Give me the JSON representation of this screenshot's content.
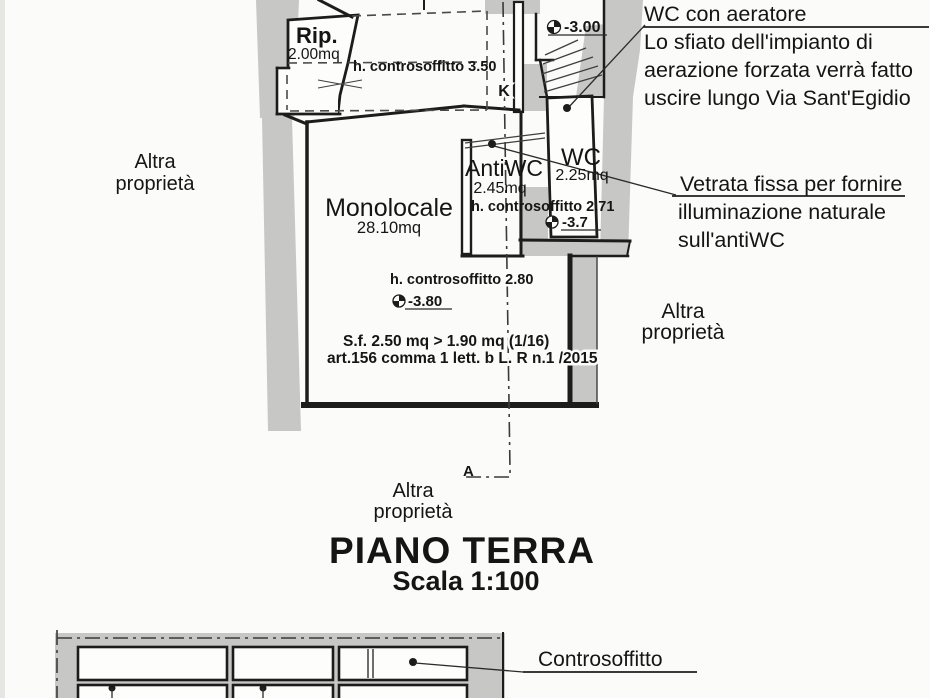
{
  "title": {
    "main": "PIANO TERRA",
    "scale": "Scala 1:100"
  },
  "rooms": {
    "rip": {
      "name": "Rip.",
      "area": "2.00mq"
    },
    "monolocale": {
      "name": "Monolocale",
      "area": "28.10mq"
    },
    "antiwc": {
      "name": "AntiWC",
      "area": "2.45mq"
    },
    "wc": {
      "name": "WC",
      "area": "2.25mq"
    }
  },
  "ceiling_heights": {
    "hall": "h. controsoffitto 3.50",
    "antiwc": "h. controsoffitto 2.71",
    "monolocale": "h. controsoffitto 2.80"
  },
  "levels": {
    "entry": "-3.00",
    "wc": "-3.7",
    "monolocale": "-3.80"
  },
  "regulation_note": {
    "line1": "S.f. 2.50 mq > 1.90 mq (1/16)",
    "line2": "art.156 comma 1 lett. b L. R n.1 /2015"
  },
  "section_marks": {
    "top": "K",
    "bottom": "A"
  },
  "neighbors": {
    "left": {
      "line1": "Altra",
      "line2": "proprietà"
    },
    "right": {
      "line1": "Altra",
      "line2": "proprietà"
    },
    "bottom": {
      "line1": "Altra",
      "line2": "proprietà"
    }
  },
  "annotations": {
    "aerator": {
      "title": "WC con aeratore",
      "line1": "Lo sfiato dell'impianto di",
      "line2": "aerazione forzata verrà fatto",
      "line3": "uscire lungo Via Sant'Egidio"
    },
    "vetrata": {
      "line1": "Vetrata fissa per fornire",
      "line2": "illuminazione naturale",
      "line3": "sull'antiWC"
    },
    "section_detail": {
      "controsoffitto": "Controsoffitto"
    }
  },
  "colors": {
    "paper": "#fbfbf9",
    "wall_grey": "#c7c7c5",
    "line": "#1c1c1c"
  }
}
